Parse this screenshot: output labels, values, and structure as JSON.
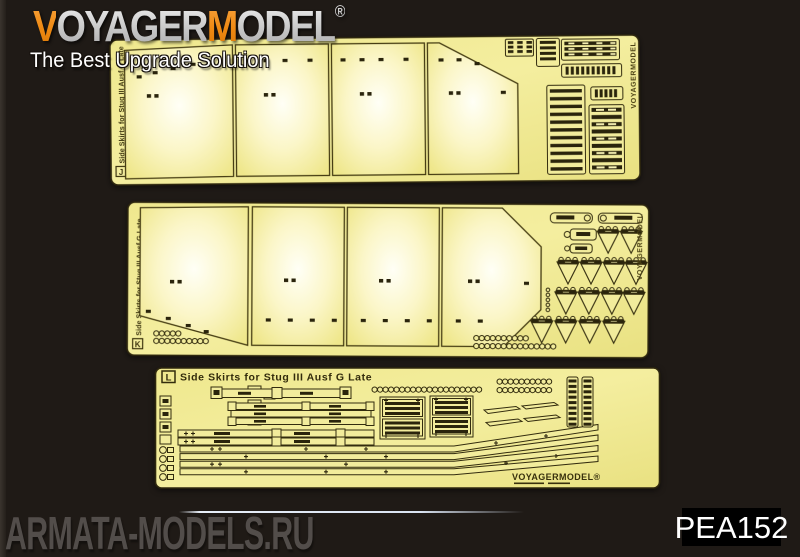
{
  "header": {
    "logo": {
      "v": "V",
      "oyager": "OYAGER",
      "m": "M",
      "odel": "ODEL",
      "registered": "®"
    },
    "tagline": "The Best Upgrade Solution"
  },
  "frets": {
    "j": {
      "code": "J",
      "side_label": "Side Skirts for Stug III Ausf G Late",
      "edge_brand": "VOYAGERMODEL"
    },
    "k": {
      "code": "K",
      "side_label": "Side Skirts for Stug III Ausf G Late",
      "edge_brand": "VOYAGERMODEL"
    },
    "l": {
      "code": "L",
      "title": "Side Skirts for Stug III Ausf G Late",
      "brand_mark": "VOYAGERMODEL®"
    }
  },
  "footer": {
    "product_code": "PEA152",
    "watermark": "ARMATA-MODELS.RU"
  },
  "colors": {
    "background": "#1F1A16",
    "brass": "#F2EC9C",
    "brass_highlight": "#FFFEF4",
    "etch_dark": "#2A240C",
    "panel_line": "#453C12",
    "logo_orange": "#EF8A16",
    "logo_silver": "#C9C8C6",
    "watermark_gray": "#524D4A",
    "code_text": "#FFFFFF",
    "code_bg": "#000000"
  }
}
